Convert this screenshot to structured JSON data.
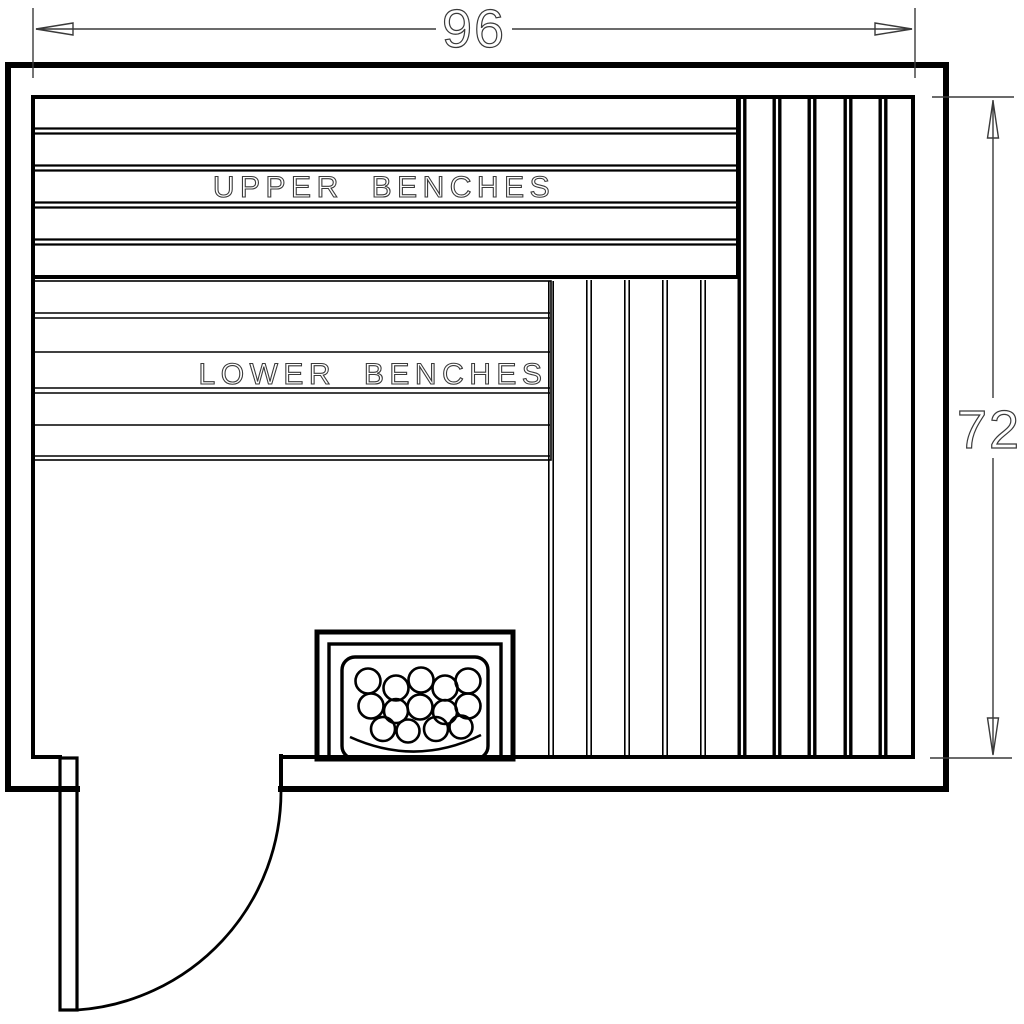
{
  "drawing": {
    "type": "sauna-floor-plan",
    "background_color": "#ffffff",
    "line_color": "#000000",
    "dimension_color": "#3a3a3a",
    "labels": {
      "upper_benches": "UPPER BENCHES",
      "lower_benches": "LOWER BENCHES"
    },
    "dimensions": {
      "width_value": "96",
      "height_value": "72"
    }
  }
}
